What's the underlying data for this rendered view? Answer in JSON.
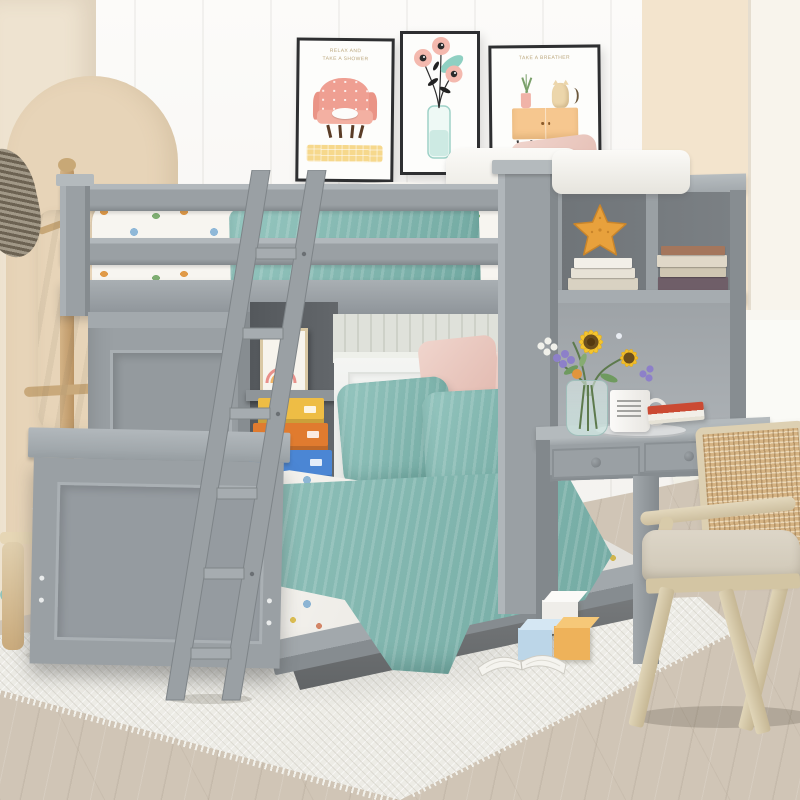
{
  "scene": {
    "description": "Kids bedroom product photo: gray twin loft bed with guard rails and ladder over a full-size bed, built-in wardrobe and open shelving, bookcase hutch with desk and two drawers, styled with teal and floral bedding, three wall art prints, wooden coat rack with towels, rattan chair, toy blocks and an open book on a white rug over a wood floor."
  },
  "palette": {
    "wall-white": "#f7f5f1",
    "beige-wall": "#eee3d0",
    "arch-beige": "#e7d4b8",
    "cream-wall": "#f3e4cd",
    "bed-gray": "#9aa0a4",
    "bed-gray-dark": "#82888c",
    "bed-gray-light": "#b2b8bc",
    "sheet-white": "#f7f5f0",
    "teal": "#82bcb4",
    "pink": "#ecccc4",
    "floor-wood": "#d0c5b6",
    "rug-white": "#edece6",
    "wood-tan": "#c9a87c",
    "cane": "#d5b383",
    "starfish-orange": "#e8a13c",
    "box-yellow": "#eebd45",
    "box-orange": "#e07b2f",
    "box-blue": "#4b86d4",
    "book-red": "#cb4a33",
    "poster-pink": "#ef9f92",
    "poster-peach": "#f6c78f",
    "poster-yellow": "#f6d88c"
  },
  "posters": [
    {
      "caption_line1": "RELAX AND",
      "caption_line2": "TAKE A SHOWER",
      "subject": "pink armchair with sleeping cat on yellow rug"
    },
    {
      "subject": "pink poppies in a glass vase"
    },
    {
      "caption_line1": "TAKE A BREATHER",
      "subject": "cat and potted plant on a peach sideboard"
    }
  ]
}
